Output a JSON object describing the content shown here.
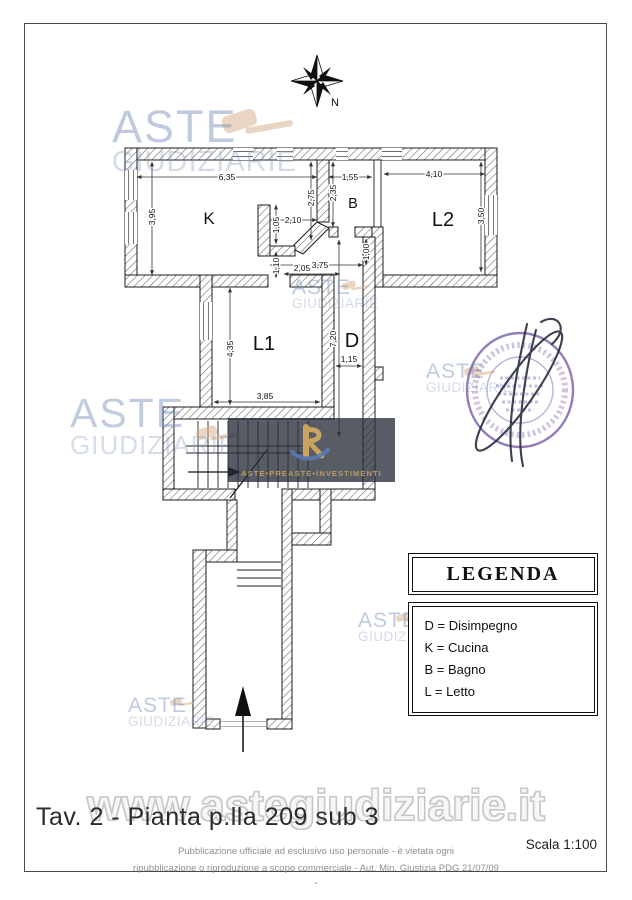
{
  "document": {
    "title": "Tav. 2 - Pianta p.lla 209 sub 3",
    "scale_label": "Scala 1:100",
    "disclaimer_line1": "Pubblicazione ufficiale ad esclusivo uso personale - è vietata ogni",
    "disclaimer_line2": "ripubblicazione o riproduzione a scopo commerciale - Aut. Min. Giustizia PDG 21/07/09",
    "footer_dash": "-"
  },
  "compass": {
    "north_label": "N"
  },
  "watermarks": {
    "brand_line1": "ASTE",
    "brand_line2": "GIUDIZIARIE",
    "website": "www.astegiudiziarie.it",
    "banner_text": "ASTE•PREASTE•INVESTIMENTI"
  },
  "floor_plan": {
    "rooms": {
      "kitchen": "K",
      "bathroom": "B",
      "bedroom2": "L2",
      "bedroom1": "L1",
      "hallway": "D"
    },
    "dimensions": {
      "k_width": "6,35",
      "b_width": "1,55",
      "l2_width": "4,10",
      "k_height": "3,95",
      "k_right_height": "2,75",
      "b_height": "2,35",
      "passage_width": "2,10",
      "stub_upper": "1,05",
      "stub_lower": "1,10",
      "corridor_top_width": "3,75",
      "passage_lower_width": "2,05",
      "b_door_height": "1,00",
      "l2_height": "3,50",
      "l1_height": "4,35",
      "l1_width": "3,85",
      "d_length": "7,20",
      "d_width": "1,15"
    }
  },
  "legend": {
    "title": "LEGENDA",
    "items": [
      "D = Disimpegno",
      "K = Cucina",
      "B = Bagno",
      "L = Letto"
    ]
  },
  "colors": {
    "watermark_blue": "#8298c1",
    "stamp_purple": "#7a5cab",
    "gavel_tan": "#d8b28e",
    "banner_gold": "#bd9c62"
  }
}
